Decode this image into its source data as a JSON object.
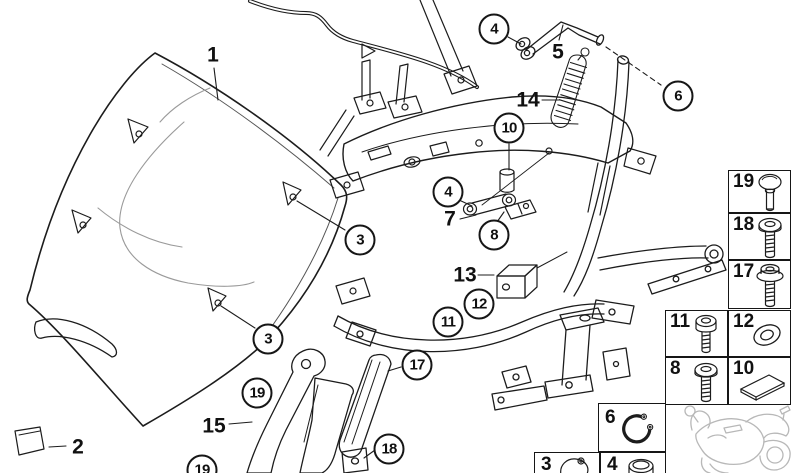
{
  "figure": {
    "description": "Exploded parts diagram of a motorcycle windshield and mounting bracket assembly",
    "background": "#ffffff",
    "line_color": "#1c1c1c",
    "sketch_color": "#9a9a9a",
    "thumbnail_color": "#b8b8b8"
  },
  "callouts": {
    "circled": [
      {
        "id": "4-top",
        "label": "4"
      },
      {
        "id": "6",
        "label": "6"
      },
      {
        "id": "10",
        "label": "10"
      },
      {
        "id": "4-mid",
        "label": "4"
      },
      {
        "id": "8",
        "label": "8"
      },
      {
        "id": "3-upper",
        "label": "3"
      },
      {
        "id": "12",
        "label": "12"
      },
      {
        "id": "11",
        "label": "11"
      },
      {
        "id": "3-lower",
        "label": "3"
      },
      {
        "id": "17",
        "label": "17"
      },
      {
        "id": "19-upper",
        "label": "19"
      },
      {
        "id": "18",
        "label": "18"
      },
      {
        "id": "19-lower",
        "label": "19"
      }
    ],
    "plain": [
      {
        "id": "1",
        "label": "1"
      },
      {
        "id": "5",
        "label": "5"
      },
      {
        "id": "14",
        "label": "14"
      },
      {
        "id": "7",
        "label": "7"
      },
      {
        "id": "13",
        "label": "13"
      },
      {
        "id": "15",
        "label": "15"
      },
      {
        "id": "2",
        "label": "2"
      }
    ]
  },
  "legend": {
    "items": [
      {
        "label": "19",
        "icon": "oval-head-screw"
      },
      {
        "label": "18",
        "icon": "pan-head-screw"
      },
      {
        "label": "17",
        "icon": "flange-bolt"
      },
      {
        "label": "11",
        "icon": "socket-head-screw"
      },
      {
        "label": "12",
        "icon": "washer"
      },
      {
        "label": "8",
        "icon": "pan-head-screw"
      },
      {
        "label": "10",
        "icon": "spacer-plate"
      },
      {
        "label": "6",
        "icon": "retaining-ring"
      },
      {
        "label": "3",
        "icon": "rubber-grommet"
      },
      {
        "label": "4",
        "icon": "cap"
      }
    ]
  },
  "thumbnail": {
    "name": "motorcycle-reference-sketch"
  }
}
